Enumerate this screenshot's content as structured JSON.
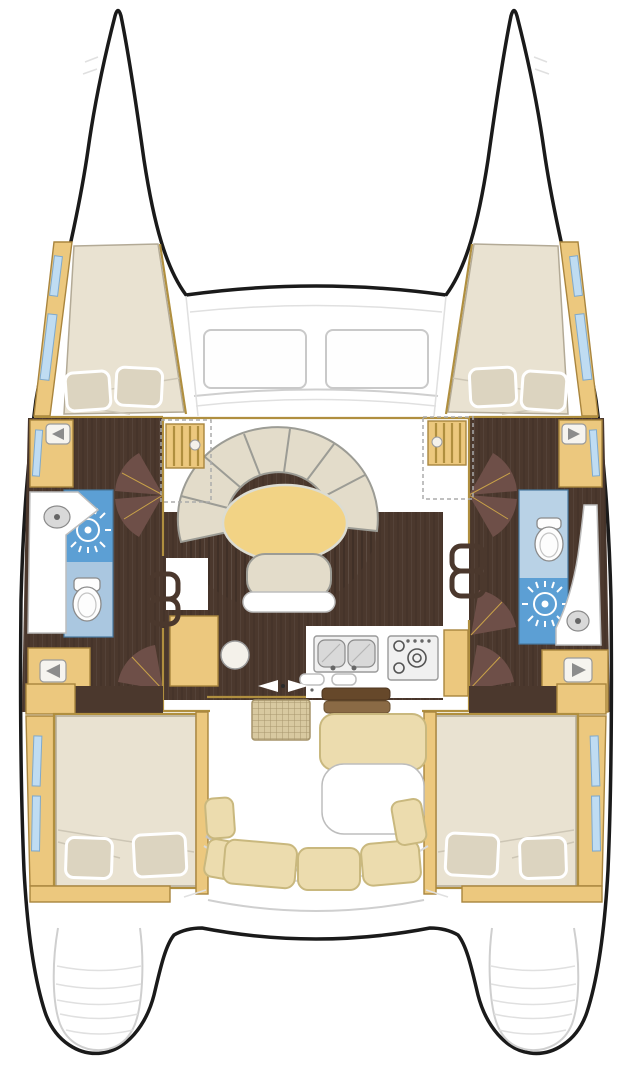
{
  "diagram": {
    "type": "catamaran-deck-plan",
    "orientation": "bow-up",
    "text_labels": [],
    "areas": [
      "forward-cabin-port",
      "forward-cabin-starboard",
      "bathroom-port",
      "bathroom-starboard",
      "salon-settee",
      "salon-table",
      "nav-station",
      "galley-sink",
      "galley-stove",
      "aft-cabin-port",
      "aft-cabin-starboard",
      "cockpit",
      "cockpit-table",
      "transom-steps-port",
      "transom-steps-starboard"
    ],
    "icons": [
      "shower-drain-icon",
      "toilet-icon",
      "sink-basin-icon",
      "companionway-steps-icon",
      "door-swing-icon",
      "wall-lamp-icon",
      "stove-burner-icon",
      "sliding-door-arrow-icon"
    ]
  },
  "colors": {
    "outline": "#1a1a1a",
    "deck_line": "#cfcfcf",
    "cabinetry": "#ecc87e",
    "cabinetry_edge": "#a9853e",
    "trim_gold": "#b08f3f",
    "floor_dark": "#4b382d",
    "door_leaf": "#6e4f48",
    "mattress": "#e9e2d1",
    "mattress_edge": "#b3aa96",
    "pillow": "#dcd4c0",
    "cushion": "#e3dcca",
    "cushion_edge": "#9c9c95",
    "seat_tan": "#ecdcae",
    "seat_edge": "#c9b87e",
    "table_gold": "#f2d385",
    "bath_blue": "#5c9fd4",
    "bath_blue_light": "#aac7e0",
    "bath_blue_pale": "#b9d2e6",
    "window_blue": "#bfdcf2",
    "mat_tan": "#d8c9a0",
    "step_brown": "#8a6a45",
    "step_brown_dark": "#66482a"
  }
}
